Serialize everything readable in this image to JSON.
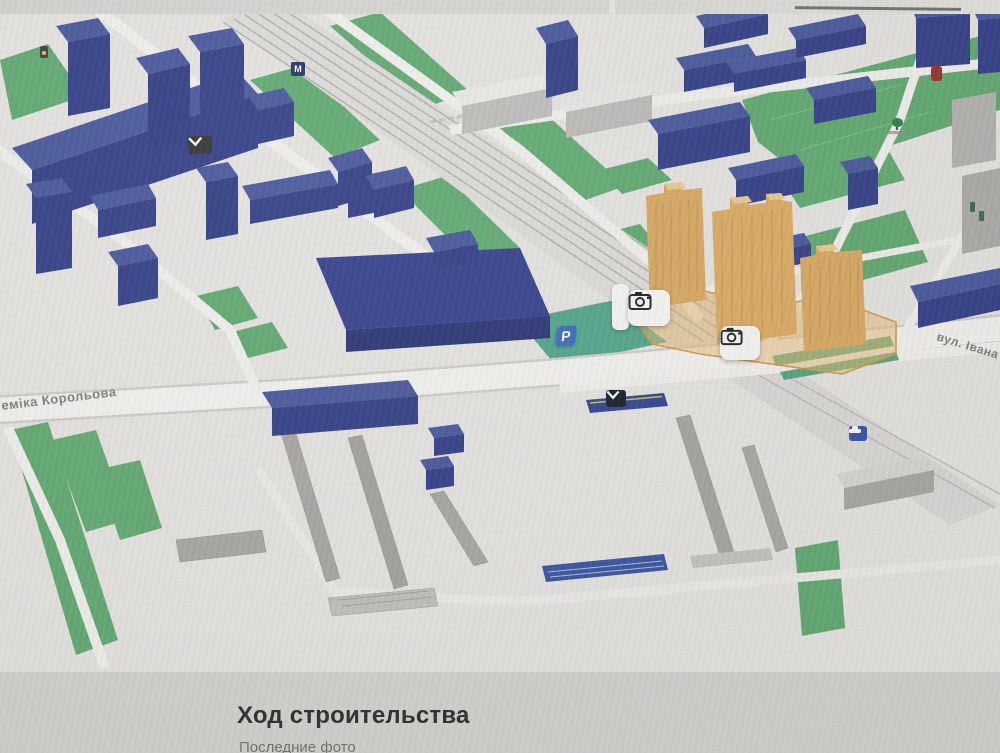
{
  "map": {
    "street_labels": {
      "korolova": "еміка Корольова",
      "ivana": "вул. Івана"
    },
    "poi": {
      "parking_label": "P",
      "metro_label": "M",
      "camera_marker_count": 2
    },
    "icons": [
      "camera-icon",
      "parking-icon",
      "metro-icon",
      "metro-entrance-icon",
      "car-icon",
      "tree-icon",
      "red-poi-icon",
      "traffic-light-icon"
    ],
    "colors": {
      "residential_building_blue": "#2b3a92",
      "construction_building_orange": "#e3a850",
      "construction_plot_outline": "#de9630",
      "green_area": "#54ad68",
      "teal_green": "#43a989",
      "parking_blue": "#2f6ad0",
      "poi_red": "#a5291f",
      "road_white": "#f6f5f2",
      "ground": "#e9e7e3"
    }
  },
  "section": {
    "heading": "Ход строительства",
    "subtext_partial": "Последние фото"
  }
}
